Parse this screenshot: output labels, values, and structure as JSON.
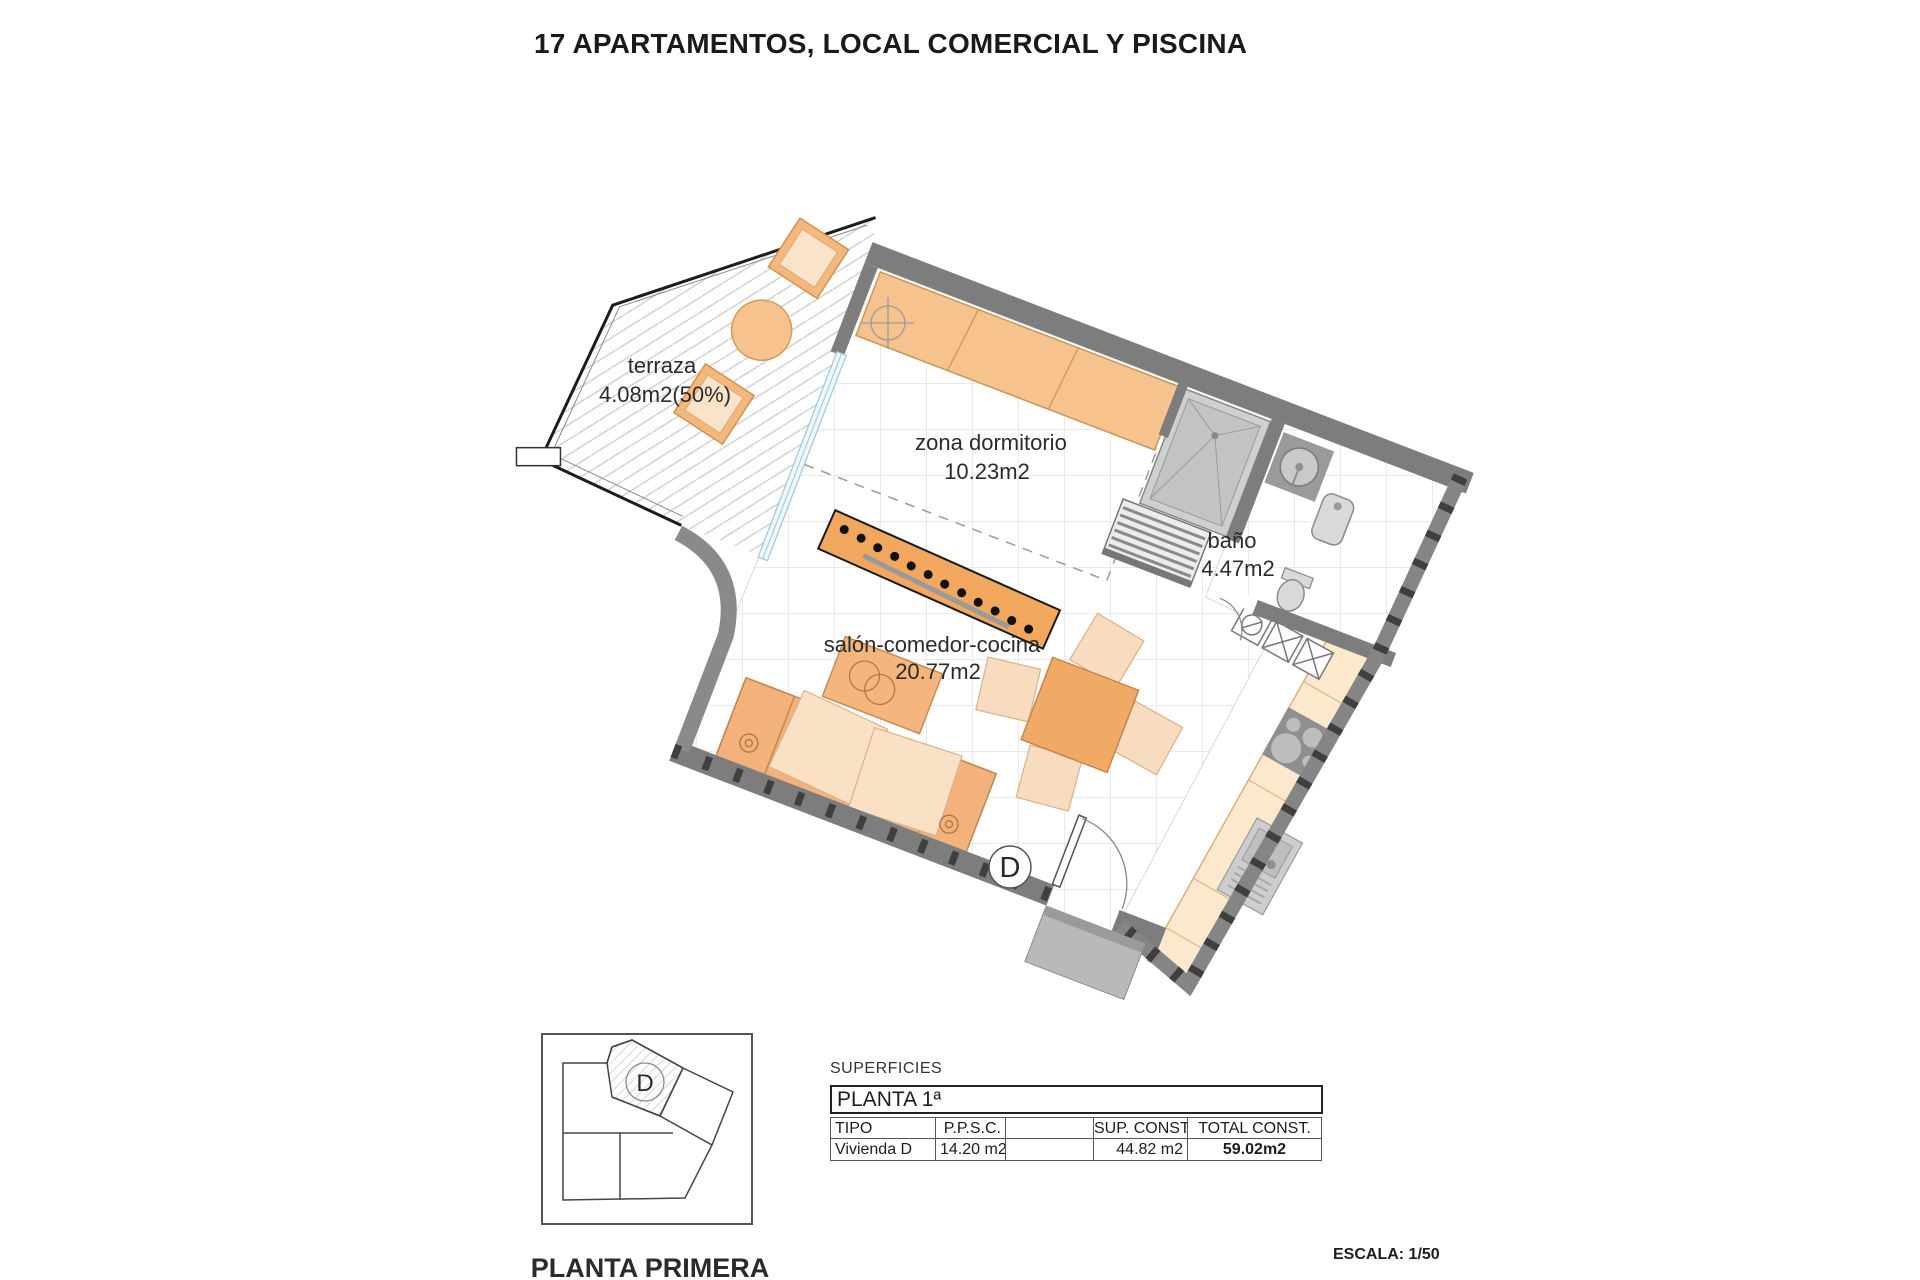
{
  "title": "17 APARTAMENTOS, LOCAL COMERCIAL Y PISCINA",
  "plan": {
    "rooms": {
      "terraza": {
        "name": "terraza",
        "area": "4.08m2(50%)"
      },
      "dormitorio": {
        "name": "zona dormitorio",
        "area": "10.23m2"
      },
      "bano": {
        "name": "baño",
        "area": "4.47m2"
      },
      "salon": {
        "name": "salón-comedor-cocina",
        "area": "20.77m2"
      }
    },
    "unit_letter": "D"
  },
  "keyplan": {
    "unit_letter": "D",
    "caption": "PLANTA PRIMERA"
  },
  "surfaces": {
    "heading": "SUPERFICIES",
    "floor": "PLANTA 1ª",
    "columns": [
      "TIPO",
      "P.P.S.C.",
      "",
      "SUP. CONST.",
      "TOTAL CONST."
    ],
    "rows": [
      [
        "Vivienda D",
        "14.20 m2",
        "",
        "44.82 m2",
        "59.02m2"
      ]
    ]
  },
  "scale_note": "ESCALA: 1/50",
  "colors": {
    "wall_gray": "#7d7d7d",
    "fixture_gray": "#c9c9c9",
    "furniture_orange": "#f3b27b",
    "furniture_pale": "#fae1c6",
    "counter_peach": "#fce8cd",
    "glass_blue": "#9cc8d8",
    "tile_line": "#dedede"
  }
}
